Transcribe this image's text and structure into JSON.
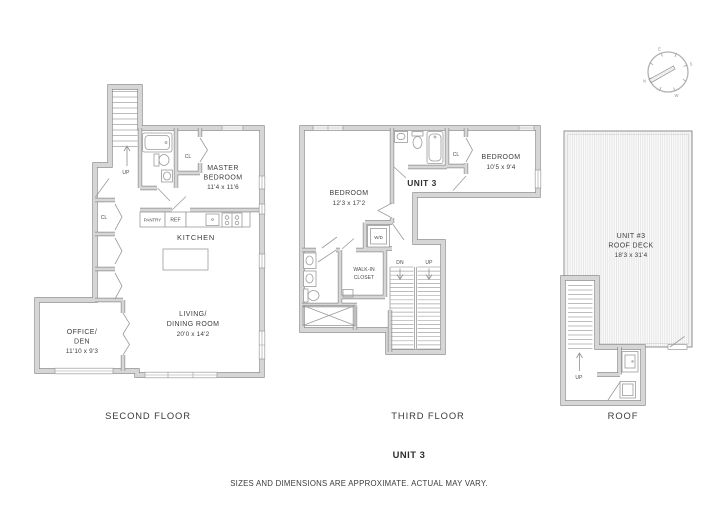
{
  "compass": {
    "n": "N",
    "e": "E",
    "s": "S",
    "w": "W"
  },
  "floors": {
    "second": {
      "label": "SECOND FLOOR",
      "up": "UP",
      "cl_hall": "CL",
      "cl_master": "CL",
      "pantry": "PANTRY",
      "ref": "REF",
      "kitchen": "KITCHEN",
      "master": {
        "l1": "MASTER",
        "l2": "BEDROOM",
        "dims": "11'4 x 11'6"
      },
      "living": {
        "l1": "LIVING/",
        "l2": "DINING ROOM",
        "dims": "20'0 x 14'2"
      },
      "office": {
        "l1": "OFFICE/",
        "l2": "DEN",
        "dims": "11'10 x 9'3"
      }
    },
    "third": {
      "label": "THIRD FLOOR",
      "unit": "UNIT 3",
      "bedroom1": {
        "name": "BEDROOM",
        "dims": "12'3 x 17'2"
      },
      "bedroom2": {
        "name": "BEDROOM",
        "dims": "10'5 x 9'4"
      },
      "walkin": {
        "l1": "WALK-IN",
        "l2": "CLOSET"
      },
      "wd": "W/D",
      "cl": "CL",
      "dn": "DN",
      "up": "UP"
    },
    "roof": {
      "label": "ROOF",
      "deck": {
        "l1": "UNIT #3",
        "l2": "ROOF DECK",
        "dims": "18'3 x 31'4"
      },
      "up": "UP"
    }
  },
  "footer": {
    "unit": "UNIT 3",
    "disclaimer": "SIZES AND DIMENSIONS ARE APPROXIMATE. ACTUAL MAY VARY."
  }
}
